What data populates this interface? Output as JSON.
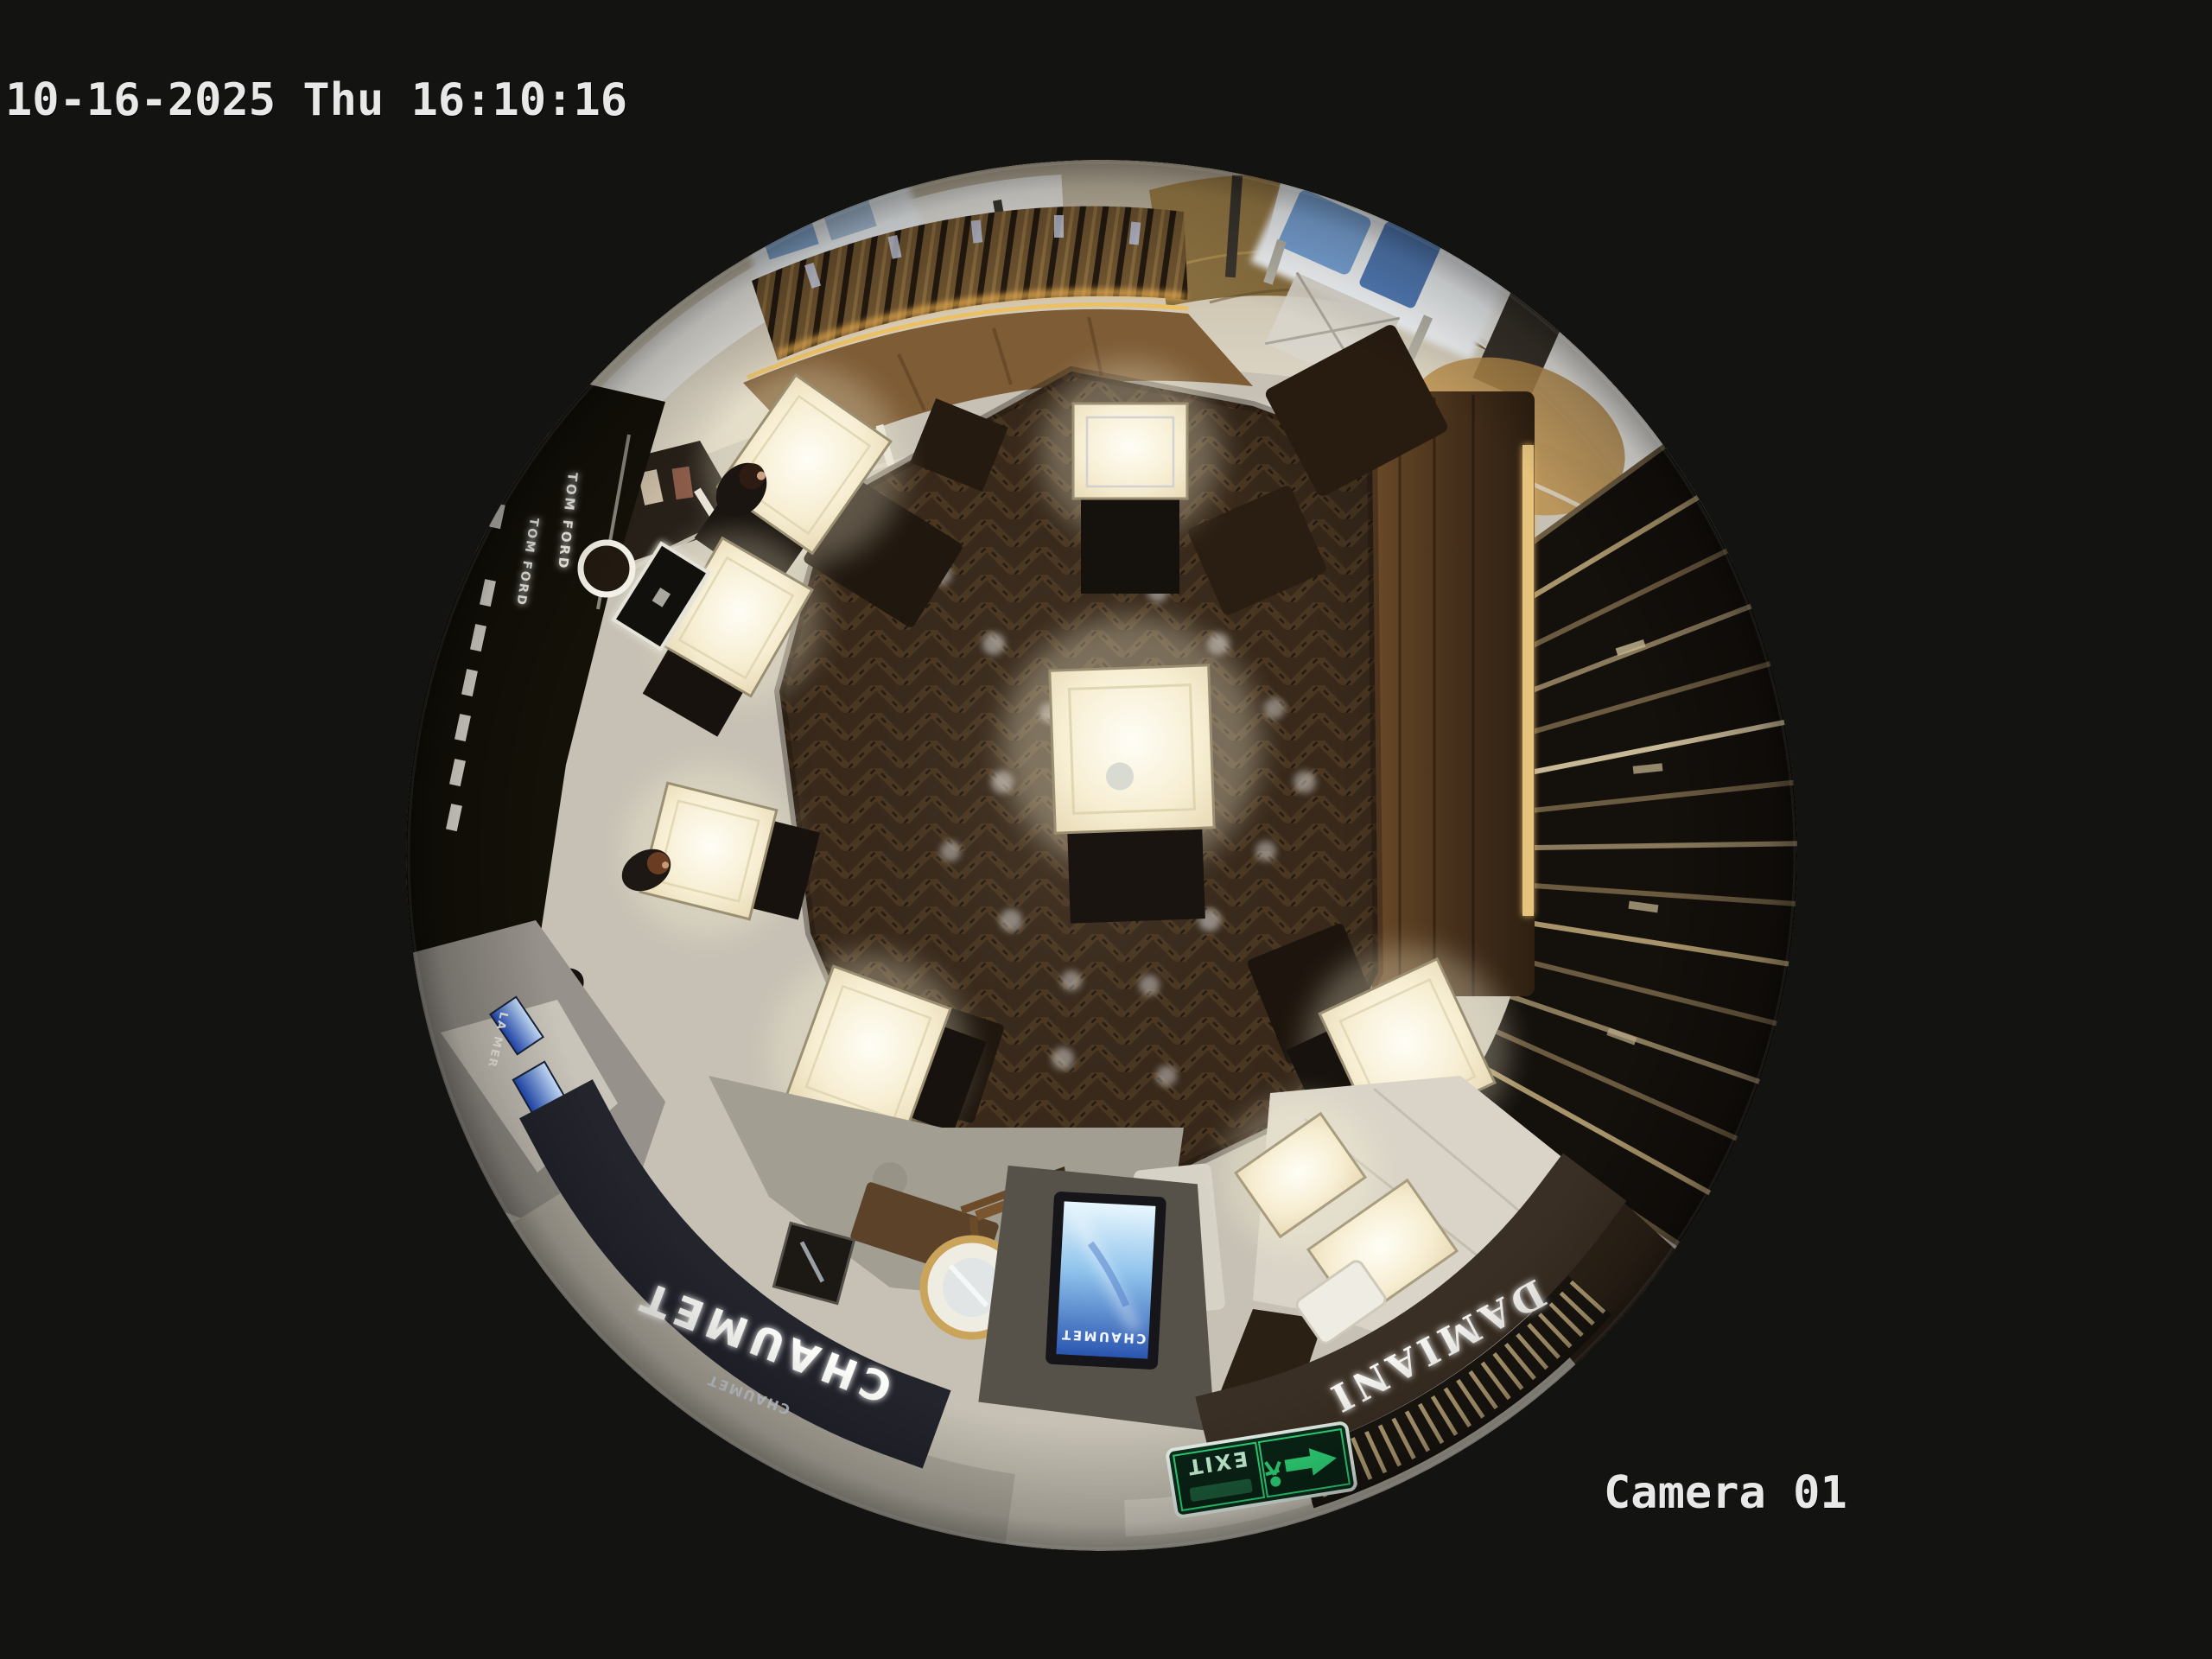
{
  "osd": {
    "timestamp": "10-16-2025 Thu 16:10:16",
    "camera_label": "Camera 01",
    "text_color": "#e8e8e8"
  },
  "scene": {
    "signage": {
      "tom_ford": "TOM FORD",
      "tom_ford_2": "TOM FORD",
      "chaumet_fascia": "CHAUMET",
      "chaumet_fascia_small": "CHAUMET",
      "chaumet_kiosk_screen": "CHAUMET",
      "damiani_fascia": "DAMIANI",
      "damiani_fascia_small": "DAMIANI",
      "la_mer": "LA MER",
      "exit": "EXIT"
    },
    "colors": {
      "background": "#131311",
      "wood_floor": "#38291b",
      "stone_floor": "#c6c1b4",
      "marble_corridor": "#d8d2c2",
      "gold_wall": "#8f7644",
      "case_light": "#fdf8e8",
      "kiosk_screen_blue": "#2a55b0",
      "exit_green": "#2fd87a",
      "chaumet_fascia_bg": "#23242c",
      "damiani_fascia_bg": "#3a2f24",
      "tom_ford_wall": "#141109"
    }
  }
}
